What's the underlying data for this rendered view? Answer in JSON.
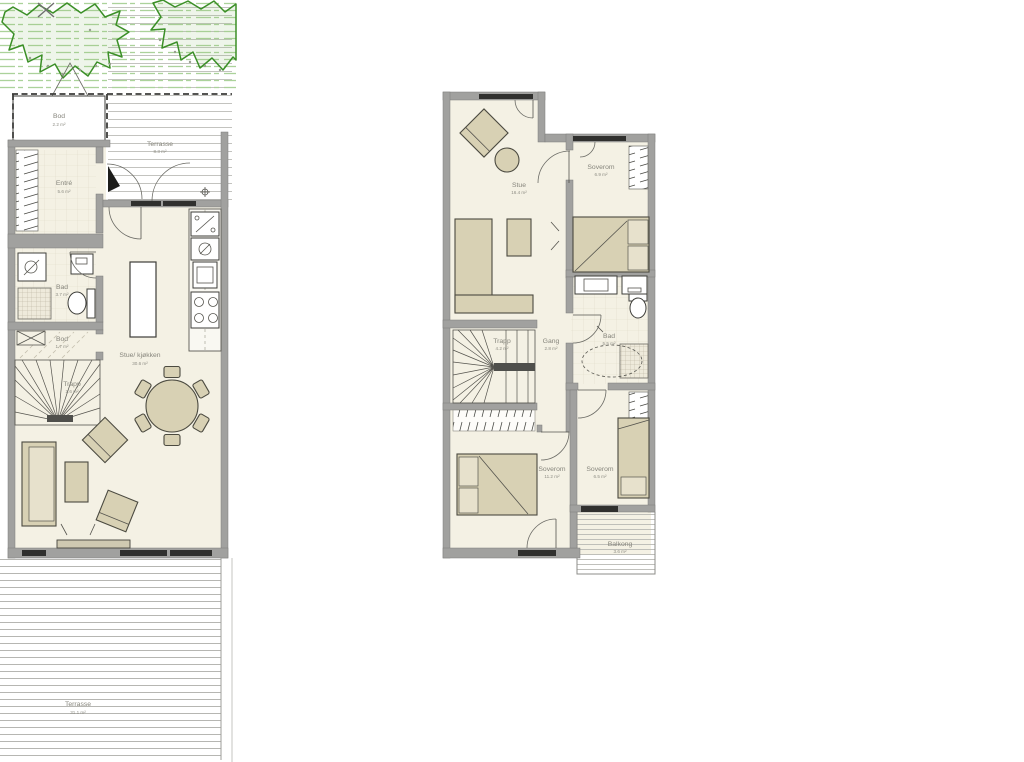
{
  "colors": {
    "wall": "#a1a19f",
    "floor": "#f4f1e4",
    "furniture": "#d8d1b4",
    "vegetation": "#3b8f27",
    "deck_line": "#b6b6b2",
    "label_text": "#86857c"
  },
  "floor1": {
    "id": "first-floor-plan",
    "rooms": {
      "bod_top": {
        "label": "Bod",
        "area": "2.2 m²"
      },
      "terrasse_top": {
        "label": "Terrasse",
        "area": "8.3 m²"
      },
      "entre": {
        "label": "Entré",
        "area": "5.6 m²"
      },
      "bad": {
        "label": "Bad",
        "area": "3.7 m²"
      },
      "bod_inner": {
        "label": "Bod",
        "area": "1.7 m²"
      },
      "trapp": {
        "label": "Trapp",
        "area": "2.6 m²"
      },
      "stue_kjokken": {
        "label": "Stue/ kjøkken",
        "area": "30.6 m²"
      },
      "terrasse_bottom": {
        "label": "Terrasse",
        "area": "31.1 m²"
      }
    }
  },
  "floor2": {
    "id": "second-floor-plan",
    "rooms": {
      "stue": {
        "label": "Stue",
        "area": "16.4 m²"
      },
      "soverom_a": {
        "label": "Soverom",
        "area": "6.9 m²"
      },
      "trapp": {
        "label": "Trapp",
        "area": "4.2 m²"
      },
      "gang": {
        "label": "Gang",
        "area": "2.8 m²"
      },
      "bad": {
        "label": "Bad",
        "area": "5.5 m²"
      },
      "soverom_b": {
        "label": "Soverom",
        "area": "11.2 m²"
      },
      "soverom_c": {
        "label": "Soverom",
        "area": "6.5 m²"
      },
      "balkong": {
        "label": "Balkong",
        "area": "3.6 m²"
      }
    }
  }
}
